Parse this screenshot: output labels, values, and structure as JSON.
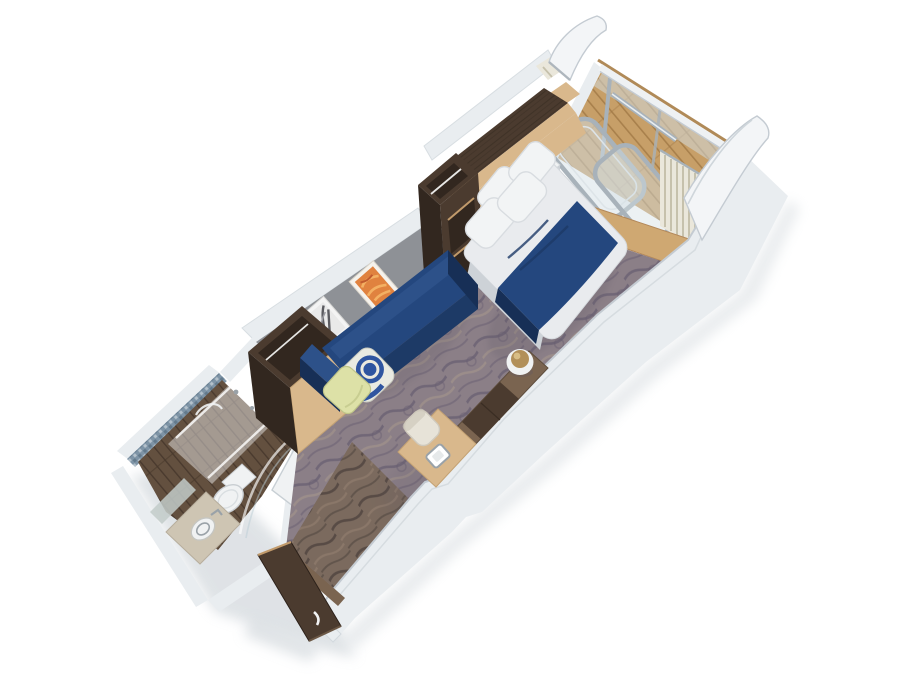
{
  "meta": {
    "title": "Balcony stateroom 3D cutaway rendering",
    "description": "Isometric 3D cutaway rendering of a cruise-ship balcony stateroom: entry hall with open door, bathroom with shower, toilet and washbasin, wardrobe, blue sofa with throw pillows, desk with chair, double bed with navy runner, cabinetry, and a private balcony with glass door, curtains, railing and wood decking."
  },
  "palette": {
    "bg": "#ffffff",
    "wall_top": "#e9edf0",
    "wall_top_bright": "#f3f5f7",
    "wall_edge": "#c4cbd2",
    "wall_inner_shade": "#d3d9dd",
    "gray_wall": "#8e9196",
    "gray_wall_dark": "#797c82",
    "carpet_base": "#8b7f87",
    "carpet_dark": "#685e71",
    "carpet_light": "#a3958c",
    "entry_base": "#7b6a5e",
    "entry_dark": "#4f433e",
    "entry_light": "#94816f",
    "balcony_wood": "#c79f68",
    "balcony_wood_line": "#a07845",
    "rail_cap_wood": "#b08a58",
    "sill_wood": "#cfa872",
    "light_wood": "#d9b88c",
    "light_wood_dark": "#c19a6b",
    "mid_wood": "#7a6450",
    "dark_wood": "#4b3b2f",
    "dark_wood_deep": "#32271f",
    "grain_line": "#3a2d23",
    "navy": "#24477e",
    "navy_mid": "#1d3a66",
    "navy_dark": "#172f56",
    "navy_hi": "#2d5189",
    "bed_white": "#e9ebee",
    "bed_shadow": "#cdd2d7",
    "pillow_white": "#f2f4f5",
    "pillow_edge": "#d8dce0",
    "pillow_yellow": "#dde1a7",
    "pillow_yellow_dark": "#bfc488",
    "pillow_ground": "#e9eae2",
    "pillow_blue": "#2f55a0",
    "curtain": "#eae7db",
    "curtain_pleat": "#c6c1ac",
    "glass": "#d4e0e5",
    "glass_deep": "#bccdd5",
    "frame_gray": "#a8b2ba",
    "frame_light": "#dde4e8",
    "mosaic": "#7e94a6",
    "mosaic_dark": "#5d7386",
    "bath_floor": "#63503f",
    "bath_floor_line": "#47382c",
    "fixture_white": "#f0f2f3",
    "fixture_shade": "#c9ced2",
    "counter_beige": "#cec5b3",
    "mirror": "#c2cbc9",
    "chrome": "#9aa2a8",
    "stool_gold": "#b2905a",
    "stool_gold_hi": "#d8bd85",
    "chair_cream": "#e7e3d8",
    "chair_edge": "#cfc9bc",
    "shadow": "#b9c0c7",
    "soft_shadow": "#5f5866"
  },
  "scene": {
    "labels": {
      "rendering": "Stateroom 3D cutaway rendering",
      "balcony": "Private balcony",
      "railing": "Balcony railing",
      "partition_left": "Balcony partition (aft)",
      "partition_right": "Balcony partition (forward)",
      "balcony_door": "Balcony glass door",
      "curtain_left": "Curtain (left of balcony door)",
      "curtain_right": "Curtain (right of balcony door)",
      "threshold": "Balcony threshold sill",
      "carpet": "Stateroom carpet",
      "hallway": "Entry hallway",
      "entry_door": "Stateroom entry door",
      "bathroom": "Bathroom",
      "shower": "Shower with glass screen",
      "toilet": "Toilet",
      "washbasin": "Washbasin vanity",
      "mirror": "Vanity mirror",
      "bathroom_door": "Bathroom door",
      "wardrobe": "Wardrobe cabinet",
      "gray_wall": "Accent wall",
      "art_orange": "Framed abstract artwork",
      "art_photo": "Framed artwork",
      "sofa": "Sofa",
      "pillow_blue": "Patterned throw pillow",
      "pillow_yellow": "Throw pillow",
      "overhead_cabinet": "Overhead cabinets",
      "shelf_unit": "Open shelf unit",
      "closet": "Closet front",
      "bed": "Double bed",
      "bed_runner": "Navy bed runner",
      "bed_pillows": "Bed pillows",
      "nightstand": "Nightstand",
      "counter": "Vanity counter",
      "minibar": "Minibar cabinet",
      "desk": "Desk",
      "desk_chair": "Desk chair",
      "desk_tray": "Desk tray",
      "sphere": "Decorative sphere",
      "right_wall": "Starboard cabin wall",
      "outer_walls": "Cutaway cabin walls"
    }
  }
}
